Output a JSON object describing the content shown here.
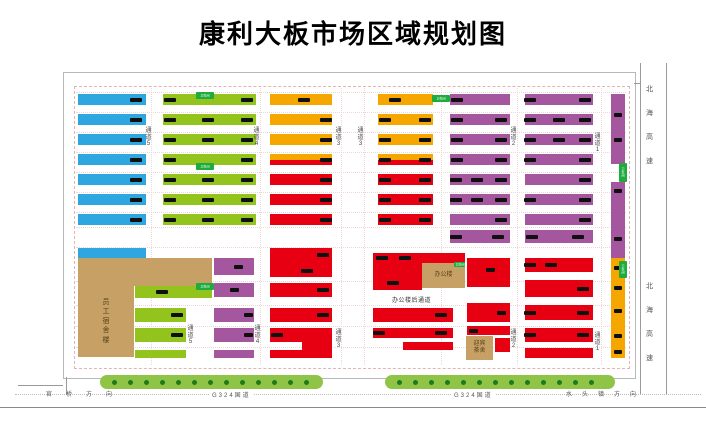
{
  "title": "康利大板市场区域规划图",
  "colors": {
    "blue": "#2EA7E0",
    "green": "#93C41D",
    "orange": "#F5A700",
    "red": "#E60012",
    "purple": "#A4579E",
    "tan": "#C7A066",
    "belt": "#8FC447",
    "belt_dot": "#1E7A1E",
    "badge": "#1EAC3E",
    "mark": "#101010"
  },
  "frame": {
    "outer": {
      "x": 63,
      "y": 72,
      "w": 571,
      "h": 305
    },
    "inner": {
      "x": 74,
      "y": 86,
      "w": 554,
      "h": 281
    }
  },
  "guides": {
    "v": [
      151,
      260,
      341,
      364,
      441,
      517,
      601
    ],
    "h": [
      92,
      112,
      132,
      152,
      172,
      192,
      212,
      227,
      247,
      281,
      305,
      326,
      347
    ]
  },
  "stalls": [
    {
      "x": 78,
      "y": 94,
      "w": 68,
      "h": 11,
      "c": "blue",
      "m": [
        0.86
      ]
    },
    {
      "x": 78,
      "y": 114,
      "w": 68,
      "h": 11,
      "c": "blue",
      "m": [
        0.86
      ]
    },
    {
      "x": 78,
      "y": 134,
      "w": 68,
      "h": 11,
      "c": "blue",
      "m": [
        0.86
      ]
    },
    {
      "x": 78,
      "y": 154,
      "w": 68,
      "h": 11,
      "c": "blue",
      "m": [
        0.86
      ]
    },
    {
      "x": 78,
      "y": 174,
      "w": 68,
      "h": 11,
      "c": "blue",
      "m": [
        0.86
      ]
    },
    {
      "x": 78,
      "y": 194,
      "w": 68,
      "h": 11,
      "c": "blue",
      "m": [
        0.86
      ]
    },
    {
      "x": 78,
      "y": 214,
      "w": 68,
      "h": 11,
      "c": "blue",
      "m": [
        0.86
      ]
    },
    {
      "x": 78,
      "y": 248,
      "w": 68,
      "h": 10,
      "c": "blue",
      "m": []
    },
    {
      "x": 163,
      "y": 94,
      "w": 93,
      "h": 11,
      "c": "green",
      "m": [
        0.07,
        0.9
      ]
    },
    {
      "x": 163,
      "y": 114,
      "w": 93,
      "h": 11,
      "c": "green",
      "m": [
        0.07,
        0.48,
        0.9
      ]
    },
    {
      "x": 163,
      "y": 134,
      "w": 93,
      "h": 11,
      "c": "green",
      "m": [
        0.07,
        0.48,
        0.9
      ]
    },
    {
      "x": 163,
      "y": 154,
      "w": 93,
      "h": 11,
      "c": "green",
      "m": [
        0.07,
        0.9
      ]
    },
    {
      "x": 163,
      "y": 174,
      "w": 93,
      "h": 11,
      "c": "green",
      "m": [
        0.07,
        0.48,
        0.9
      ]
    },
    {
      "x": 163,
      "y": 194,
      "w": 93,
      "h": 11,
      "c": "green",
      "m": [
        0.07,
        0.48,
        0.9
      ]
    },
    {
      "x": 163,
      "y": 214,
      "w": 93,
      "h": 11,
      "c": "green",
      "m": [
        0.07,
        0.48,
        0.9
      ]
    },
    {
      "x": 270,
      "y": 94,
      "w": 62,
      "h": 11,
      "c": "orange",
      "m": [
        0.55
      ]
    },
    {
      "x": 270,
      "y": 114,
      "w": 62,
      "h": 11,
      "c": "orange",
      "m": [
        0.9
      ]
    },
    {
      "x": 270,
      "y": 134,
      "w": 62,
      "h": 11,
      "c": "orange",
      "m": [
        0.9
      ]
    },
    {
      "x": 270,
      "y": 154,
      "w": 62,
      "h": 11,
      "c": "orange",
      "c2": "red",
      "m": [
        0.9
      ]
    },
    {
      "x": 270,
      "y": 174,
      "w": 62,
      "h": 11,
      "c": "red",
      "m": [
        0.9
      ]
    },
    {
      "x": 270,
      "y": 194,
      "w": 62,
      "h": 11,
      "c": "red",
      "m": [
        0.9
      ]
    },
    {
      "x": 270,
      "y": 214,
      "w": 62,
      "h": 11,
      "c": "red",
      "m": [
        0.9
      ]
    },
    {
      "x": 378,
      "y": 94,
      "w": 55,
      "h": 11,
      "c": "orange",
      "m": [
        0.3
      ]
    },
    {
      "x": 378,
      "y": 114,
      "w": 55,
      "h": 11,
      "c": "orange",
      "m": [
        0.12,
        0.85
      ]
    },
    {
      "x": 378,
      "y": 134,
      "w": 55,
      "h": 11,
      "c": "orange",
      "m": [
        0.12,
        0.85
      ]
    },
    {
      "x": 378,
      "y": 154,
      "w": 55,
      "h": 11,
      "c": "orange",
      "c2": "red",
      "m": [
        0.12,
        0.85
      ]
    },
    {
      "x": 378,
      "y": 174,
      "w": 55,
      "h": 11,
      "c": "red",
      "m": [
        0.12,
        0.85
      ]
    },
    {
      "x": 378,
      "y": 194,
      "w": 55,
      "h": 11,
      "c": "red",
      "m": [
        0.12,
        0.85
      ]
    },
    {
      "x": 378,
      "y": 214,
      "w": 55,
      "h": 11,
      "c": "red",
      "m": [
        0.12,
        0.85
      ]
    },
    {
      "x": 450,
      "y": 94,
      "w": 60,
      "h": 11,
      "c": "purple",
      "m": [
        0.12
      ]
    },
    {
      "x": 450,
      "y": 114,
      "w": 60,
      "h": 11,
      "c": "purple",
      "m": [
        0.12,
        0.85
      ]
    },
    {
      "x": 450,
      "y": 134,
      "w": 60,
      "h": 11,
      "c": "purple",
      "m": [
        0.12,
        0.85
      ]
    },
    {
      "x": 450,
      "y": 154,
      "w": 60,
      "h": 11,
      "c": "purple",
      "m": [
        0.12,
        0.85
      ]
    },
    {
      "x": 450,
      "y": 174,
      "w": 60,
      "h": 11,
      "c": "purple",
      "m": [
        0.1,
        0.45,
        0.85
      ]
    },
    {
      "x": 450,
      "y": 194,
      "w": 60,
      "h": 11,
      "c": "purple",
      "m": [
        0.1,
        0.45,
        0.85
      ]
    },
    {
      "x": 450,
      "y": 214,
      "w": 60,
      "h": 11,
      "c": "purple",
      "m": [
        0.85
      ]
    },
    {
      "x": 450,
      "y": 230,
      "w": 60,
      "h": 13,
      "c": "purple",
      "m": [
        0.1,
        0.8
      ]
    },
    {
      "x": 525,
      "y": 94,
      "w": 68,
      "h": 11,
      "c": "purple",
      "m": [
        0.08,
        0.88
      ]
    },
    {
      "x": 525,
      "y": 114,
      "w": 68,
      "h": 11,
      "c": "purple",
      "m": [
        0.08,
        0.5,
        0.88
      ]
    },
    {
      "x": 525,
      "y": 134,
      "w": 68,
      "h": 11,
      "c": "purple",
      "m": [
        0.08,
        0.5,
        0.88
      ]
    },
    {
      "x": 525,
      "y": 154,
      "w": 68,
      "h": 11,
      "c": "purple",
      "m": [
        0.08,
        0.88
      ]
    },
    {
      "x": 525,
      "y": 174,
      "w": 68,
      "h": 11,
      "c": "purple",
      "m": [
        0.88
      ]
    },
    {
      "x": 525,
      "y": 194,
      "w": 68,
      "h": 11,
      "c": "purple",
      "m": [
        0.08,
        0.88
      ]
    },
    {
      "x": 525,
      "y": 214,
      "w": 68,
      "h": 11,
      "c": "purple",
      "m": [
        0.88
      ]
    },
    {
      "x": 525,
      "y": 230,
      "w": 68,
      "h": 13,
      "c": "purple",
      "m": [
        0.1,
        0.78
      ]
    },
    {
      "x": 611,
      "y": 94,
      "w": 14,
      "h": 70,
      "c": "purple",
      "v": true,
      "m": [
        0.3,
        0.65
      ]
    },
    {
      "x": 611,
      "y": 182,
      "w": 14,
      "h": 76,
      "c": "purple",
      "v": true,
      "m": [
        0.12,
        0.75
      ]
    },
    {
      "x": 611,
      "y": 258,
      "w": 14,
      "h": 100,
      "c": "orange",
      "v": true,
      "m": [
        0.1,
        0.3,
        0.53,
        0.78,
        0.94
      ]
    },
    {
      "x": 135,
      "y": 286,
      "w": 77,
      "h": 12,
      "c": "green",
      "m": [
        0.35
      ]
    },
    {
      "x": 135,
      "y": 308,
      "w": 51,
      "h": 14,
      "c": "green",
      "m": [
        0.82
      ]
    },
    {
      "x": 135,
      "y": 328,
      "w": 51,
      "h": 14,
      "c": "green",
      "m": [
        0.82
      ]
    },
    {
      "x": 135,
      "y": 350,
      "w": 51,
      "h": 8,
      "c": "green",
      "m": []
    },
    {
      "x": 214,
      "y": 258,
      "w": 40,
      "h": 17,
      "c": "purple",
      "m": [
        0.6
      ]
    },
    {
      "x": 214,
      "y": 283,
      "w": 40,
      "h": 14,
      "c": "purple",
      "m": [
        0.5
      ]
    },
    {
      "x": 214,
      "y": 308,
      "w": 40,
      "h": 14,
      "c": "purple",
      "m": [
        0.85
      ]
    },
    {
      "x": 214,
      "y": 328,
      "w": 40,
      "h": 14,
      "c": "purple",
      "m": [
        0.85
      ]
    },
    {
      "x": 214,
      "y": 350,
      "w": 40,
      "h": 8,
      "c": "purple",
      "m": []
    },
    {
      "x": 270,
      "y": 248,
      "w": 62,
      "h": 29,
      "c": "red",
      "m": [
        [
          0.85,
          0.25
        ],
        [
          0.6,
          0.8
        ]
      ]
    },
    {
      "x": 270,
      "y": 283,
      "w": 62,
      "h": 14,
      "c": "red",
      "m": [
        0.85
      ]
    },
    {
      "x": 270,
      "y": 308,
      "w": 62,
      "h": 14,
      "c": "red",
      "m": [
        0.85
      ]
    },
    {
      "x": 270,
      "y": 328,
      "w": 62,
      "h": 14,
      "c": "red",
      "m": [
        0.12
      ]
    },
    {
      "x": 302,
      "y": 342,
      "w": 30,
      "h": 8,
      "c": "red",
      "m": []
    },
    {
      "x": 270,
      "y": 350,
      "w": 62,
      "h": 8,
      "c": "red",
      "m": []
    },
    {
      "x": 373,
      "y": 253,
      "w": 92,
      "h": 10,
      "c": "red",
      "m": [
        0.1,
        0.35
      ]
    },
    {
      "x": 373,
      "y": 263,
      "w": 49,
      "h": 27,
      "c": "red",
      "m": [
        [
          0.4,
          0.75
        ]
      ]
    },
    {
      "x": 373,
      "y": 308,
      "w": 80,
      "h": 14,
      "c": "red",
      "m": [
        0.85
      ]
    },
    {
      "x": 373,
      "y": 328,
      "w": 80,
      "h": 10,
      "c": "red",
      "m": [
        0.08,
        0.85
      ]
    },
    {
      "x": 403,
      "y": 342,
      "w": 50,
      "h": 8,
      "c": "red",
      "m": []
    },
    {
      "x": 467,
      "y": 258,
      "w": 43,
      "h": 29,
      "c": "red",
      "m": [
        [
          0.55,
          0.4
        ]
      ]
    },
    {
      "x": 467,
      "y": 303,
      "w": 43,
      "h": 19,
      "c": "red",
      "m": [
        0.8
      ]
    },
    {
      "x": 467,
      "y": 326,
      "w": 43,
      "h": 9,
      "c": "red",
      "m": [
        0.15
      ]
    },
    {
      "x": 495,
      "y": 338,
      "w": 15,
      "h": 14,
      "c": "red",
      "m": []
    },
    {
      "x": 525,
      "y": 258,
      "w": 68,
      "h": 14,
      "c": "red",
      "m": [
        0.08,
        0.38
      ]
    },
    {
      "x": 525,
      "y": 280,
      "w": 68,
      "h": 17,
      "c": "red",
      "m": [
        0.85
      ]
    },
    {
      "x": 525,
      "y": 305,
      "w": 68,
      "h": 15,
      "c": "red",
      "m": [
        0.08,
        0.85
      ]
    },
    {
      "x": 525,
      "y": 328,
      "w": 68,
      "h": 14,
      "c": "red",
      "m": [
        0.08,
        0.85
      ]
    },
    {
      "x": 525,
      "y": 348,
      "w": 68,
      "h": 10,
      "c": "red",
      "m": []
    }
  ],
  "buildings": [
    {
      "x": 78,
      "y": 258,
      "w": 134,
      "h": 28,
      "label": ""
    },
    {
      "x": 78,
      "y": 286,
      "w": 56,
      "h": 71,
      "label": "员工宿舍楼",
      "vert": true
    },
    {
      "x": 422,
      "y": 263,
      "w": 43,
      "h": 25,
      "label": "办公楼"
    },
    {
      "x": 466,
      "y": 336,
      "w": 27,
      "h": 24,
      "label": "迎宾茶舍",
      "wrap": 2
    }
  ],
  "badges": [
    {
      "x": 196,
      "y": 92,
      "w": 18,
      "h": 7,
      "text": "卫生间"
    },
    {
      "x": 196,
      "y": 163,
      "w": 18,
      "h": 7,
      "text": "卫生间"
    },
    {
      "x": 432,
      "y": 95,
      "w": 18,
      "h": 7,
      "text": "卫生间"
    },
    {
      "x": 196,
      "y": 283,
      "w": 18,
      "h": 7,
      "text": "卫生间"
    },
    {
      "x": 454,
      "y": 262,
      "w": 11,
      "h": 5,
      "text": "卫生间"
    },
    {
      "x": 619,
      "y": 163,
      "w": 8,
      "h": 19,
      "text": "卫生间",
      "vert": true
    },
    {
      "x": 619,
      "y": 261,
      "w": 8,
      "h": 17,
      "text": "卫生间",
      "vert": true
    }
  ],
  "aisle_labels": [
    {
      "t": "通道5",
      "x": 148,
      "y": 128
    },
    {
      "t": "通道4",
      "x": 256,
      "y": 128
    },
    {
      "t": "通道3",
      "x": 338,
      "y": 128
    },
    {
      "t": "通道3",
      "x": 360,
      "y": 128
    },
    {
      "t": "通道2",
      "x": 513,
      "y": 128
    },
    {
      "t": "通道1",
      "x": 597,
      "y": 134
    },
    {
      "t": "通道5",
      "x": 190,
      "y": 326
    },
    {
      "t": "通道4",
      "x": 257,
      "y": 326
    },
    {
      "t": "通道3",
      "x": 338,
      "y": 330
    },
    {
      "t": "通道2",
      "x": 513,
      "y": 330
    },
    {
      "t": "通道1",
      "x": 597,
      "y": 333
    }
  ],
  "annotations": {
    "office_back_aisle": "办公楼后通道"
  },
  "roads": {
    "left_direction": "官桥方向",
    "right_direction": "水头镇方向",
    "national_road": "G324国道",
    "national_road_x": [
      210,
      452
    ],
    "highway": "北海高速",
    "highway_y": [
      86,
      283
    ],
    "highway_lines_x": [
      640,
      666
    ]
  },
  "tree_belts": [
    {
      "x": 100,
      "y": 375,
      "w": 223,
      "h": 14
    },
    {
      "x": 385,
      "y": 375,
      "w": 230,
      "h": 14
    }
  ]
}
